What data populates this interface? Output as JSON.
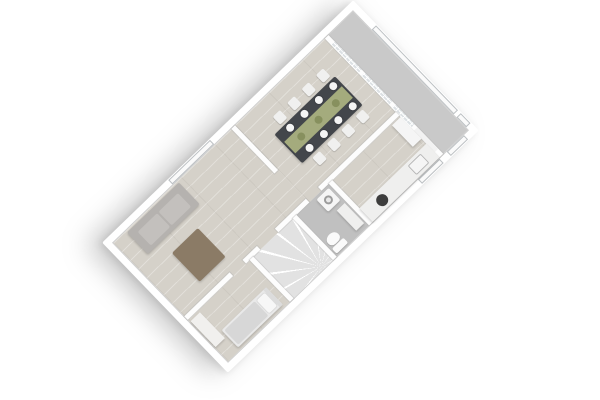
{
  "scene": {
    "view": "3d-top-down-floorplan-render",
    "rotation_deg": 46,
    "rooms": [
      {
        "id": "entry-hall"
      },
      {
        "id": "dining-room"
      },
      {
        "id": "kitchen"
      },
      {
        "id": "bathroom"
      },
      {
        "id": "staircase"
      },
      {
        "id": "living-room"
      },
      {
        "id": "bedroom"
      }
    ],
    "furniture": [
      "dining-table",
      "dining-chairs-x8",
      "plates-x8",
      "table-runner",
      "serving-bowls-x3",
      "kitchen-counter",
      "kitchen-sink",
      "hob",
      "washing-machine",
      "bathroom-sink",
      "toilet",
      "winder-staircase",
      "sofa",
      "coffee-table",
      "single-bed",
      "wardrobe"
    ]
  },
  "colors": {
    "background": "#ffffff",
    "building": "#ffffff",
    "wall": "#fdfdfd",
    "floor_wood": "#d5d1c9",
    "floor_hall": "#c9c9c9",
    "floor_bath": "#c0c0c0",
    "stairs": "#e2e2e2",
    "glass": "#dce1e4",
    "window": "#fafafa",
    "door": "#f2f2f2",
    "table": "#43464b",
    "runner": "#a4ab7d",
    "bowl": "#87905e",
    "plate": "#f4f4f4",
    "chair": "#f0f0ef",
    "sofa": "#b5b2af",
    "sofa_cushion": "#c3c0bd",
    "coffee_table": "#8b7b66",
    "bed_frame": "#e9e9e9",
    "pillow": "#f7f7f7",
    "blanket": "#d7d7d7",
    "headboard": "#dcdcdc",
    "wardrobe": "#f1f0ee",
    "appliance": "#f5f5f5",
    "hob": "#3d3d3d",
    "toilet": "#fafafa",
    "counter": "#efefee"
  }
}
